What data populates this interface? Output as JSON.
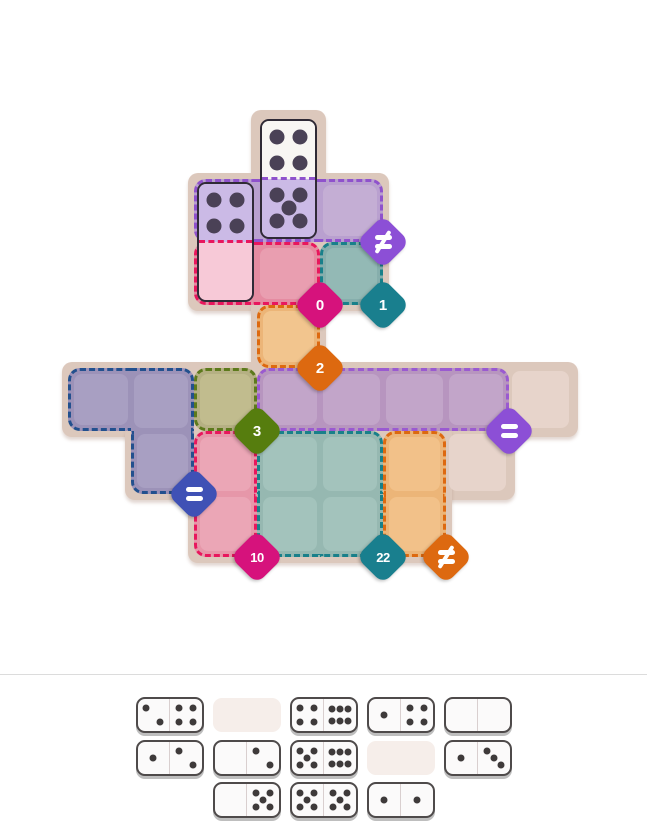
{
  "game": {
    "title": "domino-regions-puzzle",
    "grid": {
      "origin_x": 68,
      "origin_y": 116,
      "cell": 63
    },
    "backing_shapes": [
      {
        "x": 251,
        "y": 110,
        "w": 75,
        "h": 75
      },
      {
        "x": 188,
        "y": 173,
        "w": 201,
        "h": 138
      },
      {
        "x": 251,
        "y": 299,
        "w": 75,
        "h": 75
      },
      {
        "x": 62,
        "y": 362,
        "w": 516,
        "h": 75
      },
      {
        "x": 125,
        "y": 425,
        "w": 75,
        "h": 75
      },
      {
        "x": 188,
        "y": 425,
        "w": 327,
        "h": 75
      },
      {
        "x": 188,
        "y": 425,
        "w": 264,
        "h": 138
      }
    ],
    "plain_cells": {
      "fill": "#dfcbc0",
      "cell_fill": "#e7d4cb",
      "cells": [
        [
          7,
          4
        ],
        [
          6,
          5
        ]
      ]
    },
    "regions": [
      {
        "name": "region-purple-top",
        "fill": "#b9a0cf",
        "cell_fill": "#c4aed4",
        "dash": "#8f52cc",
        "cells": [
          [
            2,
            1
          ],
          [
            3,
            1
          ],
          [
            4,
            1
          ]
        ],
        "badge": {
          "kind": "neq",
          "label": "≠",
          "color": "#8c4fd6",
          "at": [
            5,
            2
          ]
        }
      },
      {
        "name": "region-pink-top",
        "fill": "#e58ba1",
        "cell_fill": "#e99eb0",
        "dash": "#e8175d",
        "cells": [
          [
            2,
            2
          ],
          [
            3,
            2
          ]
        ],
        "badge": {
          "kind": "number",
          "label": "0",
          "color": "#d6127c",
          "at": [
            4,
            3
          ]
        }
      },
      {
        "name": "region-teal-top",
        "fill": "#86aeac",
        "cell_fill": "#93b9b5",
        "dash": "#19808a",
        "cells": [
          [
            4,
            2
          ]
        ],
        "badge": {
          "kind": "number",
          "label": "1",
          "color": "#197f8e",
          "at": [
            5,
            3
          ]
        }
      },
      {
        "name": "region-orange-top",
        "fill": "#ecb578",
        "cell_fill": "#f2c58e",
        "dash": "#dd6910",
        "cells": [
          [
            3,
            3
          ]
        ],
        "badge": {
          "kind": "number",
          "label": "2",
          "color": "#dd6910",
          "at": [
            4,
            4
          ]
        }
      },
      {
        "name": "region-navy",
        "fill": "#9c92b8",
        "cell_fill": "#a89fc2",
        "dash": "#23508e",
        "cells": [
          [
            0,
            4
          ],
          [
            1,
            4
          ],
          [
            1,
            5
          ]
        ],
        "badge": {
          "kind": "eq",
          "label": "=",
          "color": "#3f51b5",
          "at": [
            2,
            6
          ]
        }
      },
      {
        "name": "region-olive",
        "fill": "#b5b083",
        "cell_fill": "#c1bc8e",
        "dash": "#5d7a1c",
        "cells": [
          [
            2,
            4
          ]
        ],
        "badge": {
          "kind": "number",
          "label": "3",
          "color": "#567d0e",
          "at": [
            3,
            5
          ]
        }
      },
      {
        "name": "region-purple-band",
        "fill": "#b795bf",
        "cell_fill": "#c2a5c9",
        "dash": "#9a5ad0",
        "cells": [
          [
            3,
            4
          ],
          [
            4,
            4
          ],
          [
            5,
            4
          ],
          [
            6,
            4
          ]
        ],
        "badge": {
          "kind": "eq",
          "label": "=",
          "color": "#8c4fd6",
          "at": [
            7,
            5
          ]
        }
      },
      {
        "name": "region-pink-low",
        "fill": "#e697a9",
        "cell_fill": "#eba6b6",
        "dash": "#e8175d",
        "cells": [
          [
            2,
            5
          ],
          [
            2,
            6
          ]
        ],
        "badge": {
          "kind": "number",
          "label": "10",
          "color": "#d6127c",
          "at": [
            3,
            7
          ]
        }
      },
      {
        "name": "region-teal-low",
        "fill": "#96b8b1",
        "cell_fill": "#a3c3bc",
        "dash": "#19808a",
        "cells": [
          [
            3,
            5
          ],
          [
            4,
            5
          ],
          [
            3,
            6
          ],
          [
            4,
            6
          ]
        ],
        "badge": {
          "kind": "number",
          "label": "22",
          "color": "#197f8e",
          "at": [
            5,
            7
          ]
        }
      },
      {
        "name": "region-orange-low",
        "fill": "#ecb578",
        "cell_fill": "#f2c189",
        "dash": "#dd6910",
        "cells": [
          [
            5,
            5
          ],
          [
            5,
            6
          ]
        ],
        "badge": {
          "kind": "neq",
          "label": "≠",
          "color": "#dd6910",
          "at": [
            6,
            7
          ]
        }
      }
    ],
    "placed_dominoes": [
      {
        "col": 3,
        "row": 0,
        "dir": "v",
        "pips": [
          4,
          5
        ],
        "half_bg": [
          "#f8f6f3",
          "#cbbae6"
        ],
        "mid_dash": "#8f52cc",
        "outline": "#2f2a36",
        "pip_color": "#4a4156"
      },
      {
        "col": 2,
        "row": 1,
        "dir": "v",
        "pips": [
          4,
          0
        ],
        "half_bg": [
          "#cbbae6",
          "#f7c9d7"
        ],
        "mid_dash": "#e8175d",
        "outline": "#2f2a36",
        "pip_color": "#4a4156"
      }
    ],
    "tray": {
      "row_y": [
        697,
        740,
        782
      ],
      "pip_color": "#3e3a3a",
      "rows": [
        [
          {
            "type": "domino",
            "pips": [
              2,
              4
            ]
          },
          {
            "type": "empty"
          },
          {
            "type": "domino",
            "pips": [
              4,
              6
            ]
          },
          {
            "type": "domino",
            "pips": [
              1,
              4
            ]
          },
          {
            "type": "domino",
            "pips": [
              0,
              0
            ]
          }
        ],
        [
          {
            "type": "domino",
            "pips": [
              1,
              2
            ]
          },
          {
            "type": "domino",
            "pips": [
              0,
              2
            ]
          },
          {
            "type": "domino",
            "pips": [
              5,
              6
            ]
          },
          {
            "type": "empty"
          },
          {
            "type": "domino",
            "pips": [
              1,
              3
            ]
          }
        ],
        [
          {
            "type": "domino",
            "pips": [
              0,
              5
            ]
          },
          {
            "type": "domino",
            "pips": [
              5,
              5
            ]
          },
          {
            "type": "domino",
            "pips": [
              1,
              1
            ]
          }
        ]
      ]
    }
  }
}
